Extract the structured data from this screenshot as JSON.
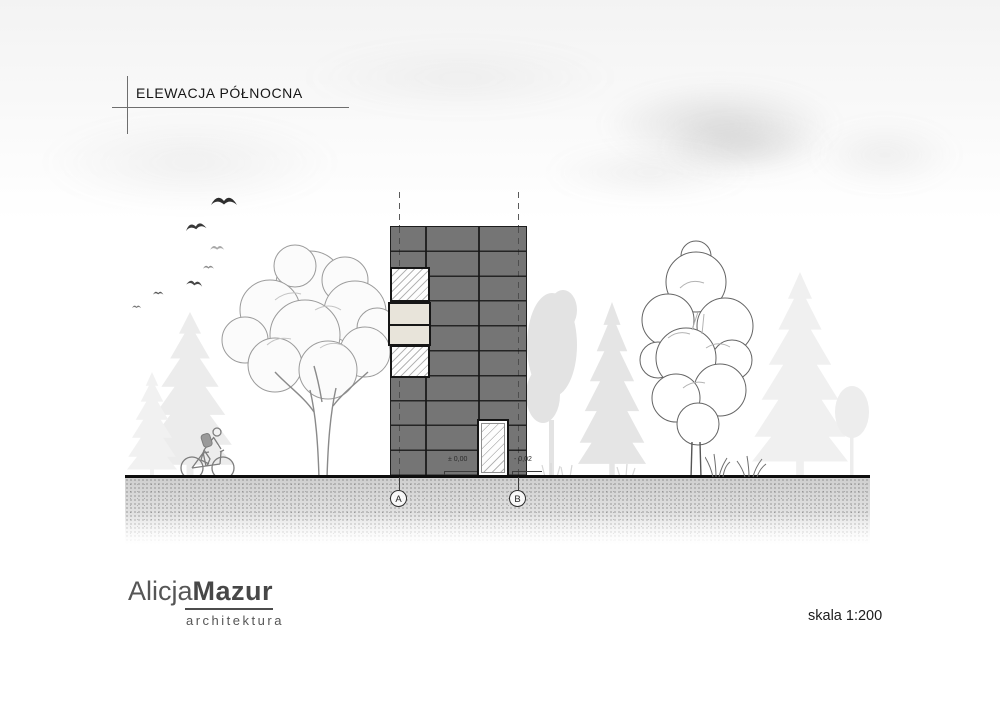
{
  "header": {
    "title": "ELEWACJA PÓŁNOCNA"
  },
  "elevation": {
    "axes": [
      {
        "label": "A"
      },
      {
        "label": "B"
      }
    ],
    "levels": [
      {
        "label": "± 0,00"
      },
      {
        "label": "- 0,02"
      }
    ]
  },
  "scenery": {
    "icons": [
      "bird-icon",
      "deciduous-tree",
      "conifer-tree",
      "cyclist",
      "grass-tuft",
      "cloud"
    ]
  },
  "footer": {
    "logo": {
      "first": "Alicja",
      "last": "Mazur",
      "subtitle": "architektura"
    },
    "scale": "skala 1:200"
  },
  "colors": {
    "facade": "#757575",
    "facade_joint": "#1d1d1d",
    "infill_panel": "#e8e4da",
    "ink": "#161616",
    "background_silhouette": "#e9e9e9"
  }
}
